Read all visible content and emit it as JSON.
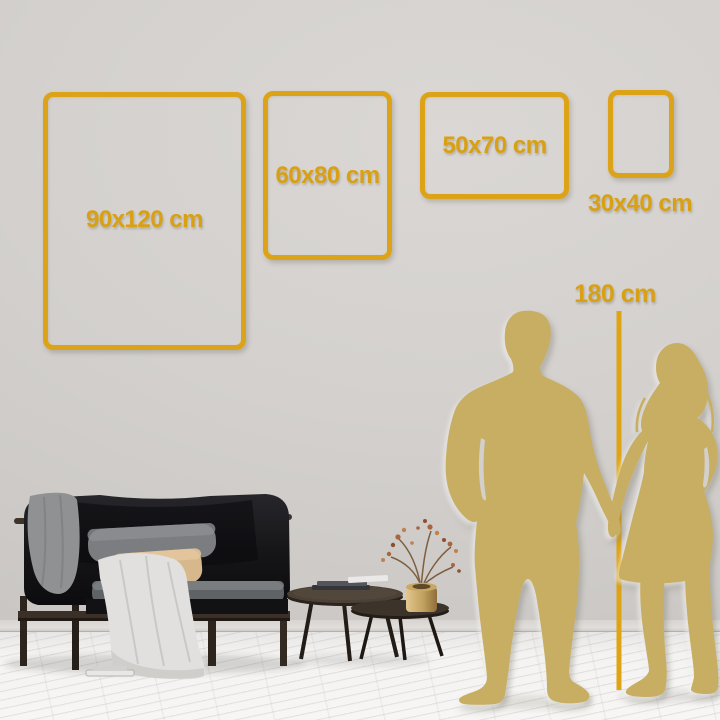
{
  "product_visual": {
    "frames": [
      {
        "size_label": "90x120 cm"
      },
      {
        "size_label": "60x80 cm"
      },
      {
        "size_label": "50x70 cm"
      },
      {
        "size_label": "30x40 cm"
      }
    ],
    "height_reference": {
      "label": "180 cm"
    },
    "colors": {
      "accent_gold": "#dca318",
      "label_gold": "#d9a013",
      "silhouette_gold": "#c8ae62",
      "wall": "#d2cfcc",
      "floor": "#f4f3f1",
      "sofa_dark": "#121214"
    }
  }
}
